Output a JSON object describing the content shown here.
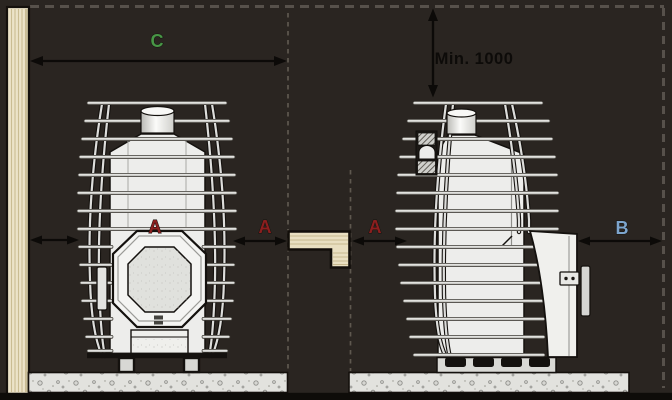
{
  "diagram": {
    "dimensions": {
      "c": {
        "label": "C",
        "color": "#489646"
      },
      "ceiling": {
        "label": "Min. 1000",
        "color": "#0d0b09"
      },
      "a_left": {
        "label": "A",
        "color": "#8c1e1e"
      },
      "a_center_left": {
        "label": "A",
        "color": "#8c1e1e"
      },
      "a_center_right": {
        "label": "A",
        "color": "#8c1e1e"
      },
      "b": {
        "label": "B",
        "color": "#7da5cd"
      }
    },
    "colors": {
      "background": "#2a2521",
      "wood": "#e9dfc1",
      "concrete": "#e2e2de",
      "stove_body": "#ededeb",
      "dash_line": "#57514b",
      "arrow": "#0c0a08"
    }
  }
}
